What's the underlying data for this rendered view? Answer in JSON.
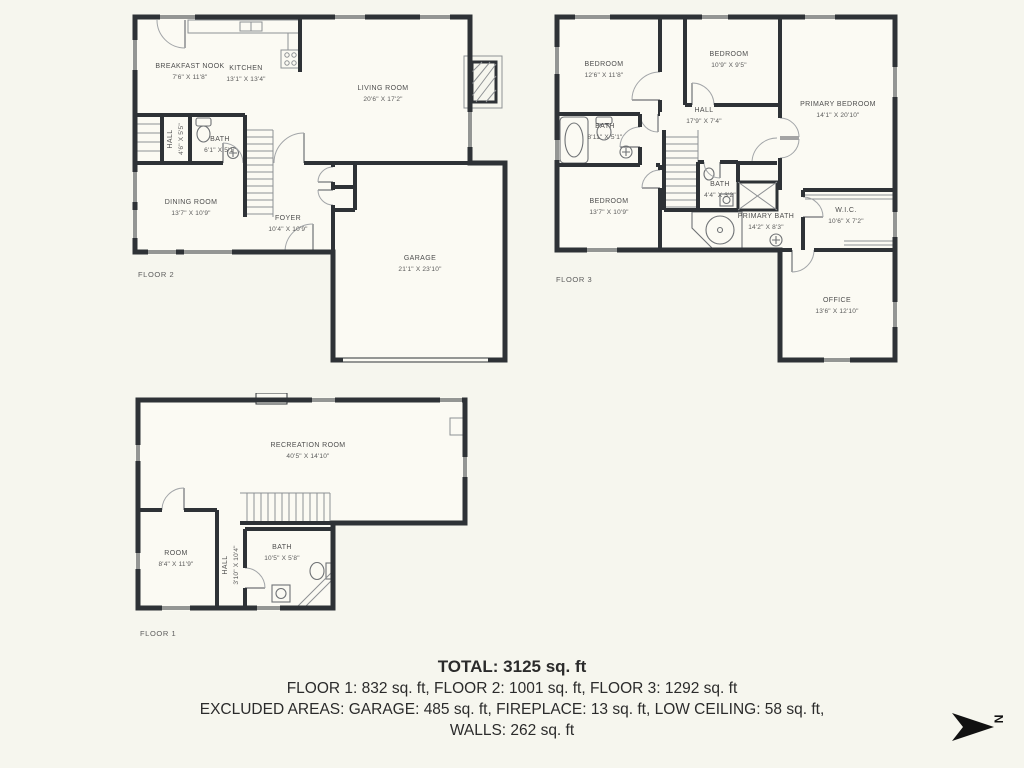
{
  "colors": {
    "background": "#f6f6ee",
    "wall": "#2e3236",
    "floor_fill": "#fbfaf3",
    "label_text": "#4e4e4e",
    "summary_text": "#2b2b2b",
    "compass": "#111111"
  },
  "floors": {
    "floor2": {
      "label": "FLOOR 2",
      "rooms": [
        {
          "name": "BREAKFAST NOOK",
          "dims": "7'6\" X 11'8\""
        },
        {
          "name": "KITCHEN",
          "dims": "13'1\" X 13'4\""
        },
        {
          "name": "LIVING ROOM",
          "dims": "20'6\" X 17'2\""
        },
        {
          "name": "HALL",
          "dims": "4'6\" X 5'5\""
        },
        {
          "name": "BATH",
          "dims": "6'1\" X 5'1\""
        },
        {
          "name": "DINING ROOM",
          "dims": "13'7\" X 10'9\""
        },
        {
          "name": "FOYER",
          "dims": "10'4\" X 10'9\""
        },
        {
          "name": "GARAGE",
          "dims": "21'1\" X 23'10\""
        }
      ]
    },
    "floor3": {
      "label": "FLOOR 3",
      "rooms": [
        {
          "name": "BEDROOM",
          "dims": "12'6\" X 11'8\""
        },
        {
          "name": "BEDROOM",
          "dims": "10'9\" X 9'5\""
        },
        {
          "name": "PRIMARY BEDROOM",
          "dims": "14'1\" X 20'10\""
        },
        {
          "name": "HALL",
          "dims": "17'9\" X 7'4\""
        },
        {
          "name": "BATH",
          "dims": "8'11\" X 5'1\""
        },
        {
          "name": "BEDROOM",
          "dims": "13'7\" X 10'9\""
        },
        {
          "name": "BATH",
          "dims": "4'4\" X 3'2\""
        },
        {
          "name": "PRIMARY BATH",
          "dims": "14'2\" X 8'3\""
        },
        {
          "name": "W.I.C.",
          "dims": "10'6\" X 7'2\""
        },
        {
          "name": "OFFICE",
          "dims": "13'6\" X 12'10\""
        }
      ]
    },
    "floor1": {
      "label": "FLOOR 1",
      "rooms": [
        {
          "name": "RECREATION ROOM",
          "dims": "40'5\" X 14'10\""
        },
        {
          "name": "ROOM",
          "dims": "8'4\" X 11'9\""
        },
        {
          "name": "HALL",
          "dims": "3'10\" X 10'4\""
        },
        {
          "name": "BATH",
          "dims": "10'5\" X 5'8\""
        }
      ]
    }
  },
  "summary": {
    "total": "TOTAL: 3125 sq. ft",
    "line2": "FLOOR 1: 832 sq. ft, FLOOR 2: 1001 sq. ft, FLOOR 3: 1292 sq. ft",
    "line3": "EXCLUDED AREAS: GARAGE: 485 sq. ft, FIREPLACE: 13 sq. ft, LOW CEILING: 58 sq. ft,",
    "line4": "WALLS: 262 sq. ft"
  },
  "compass": {
    "label": "N"
  }
}
